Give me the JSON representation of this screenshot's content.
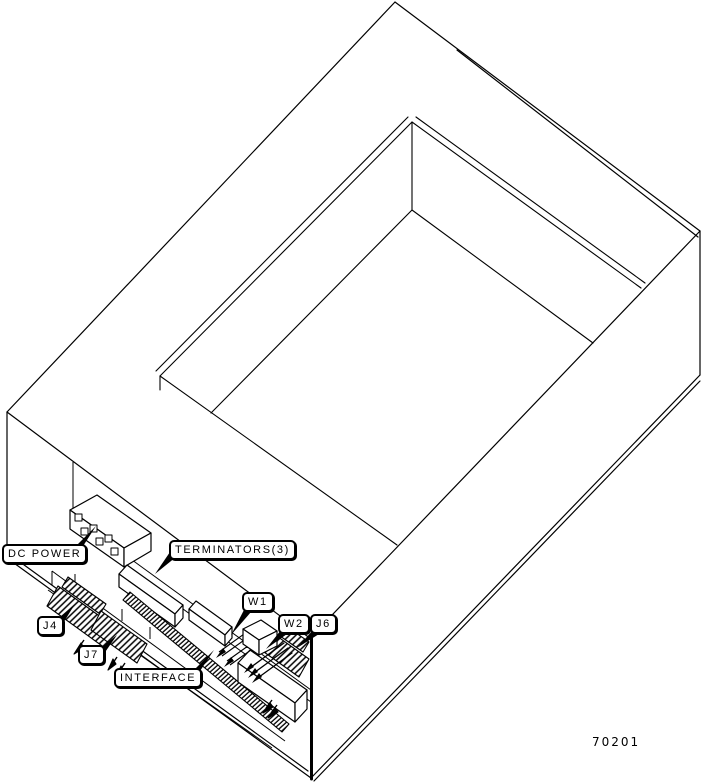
{
  "figure": {
    "figure_number": "70201",
    "description": "Isometric line drawing of an equipment enclosure (open-top drawer) with connectors on the lower-left rear panel",
    "callouts": {
      "dc_power": "DC POWER",
      "terminators": "TERMINATORS(3)",
      "w1": "W1",
      "w2": "W2",
      "j6": "J6",
      "j4": "J4",
      "j7": "J7",
      "interface": "INTERFACE"
    },
    "components": [
      "enclosure-chassis",
      "top-opening-recess",
      "dc-power-terminal-block",
      "terminator-bars",
      "w1-jumper",
      "w2-jumper",
      "j4-connector",
      "j7-connector",
      "j6-connector",
      "interface-edge-connector",
      "board-end-block"
    ],
    "colors": {
      "line": "#000000",
      "background": "#ffffff"
    }
  }
}
